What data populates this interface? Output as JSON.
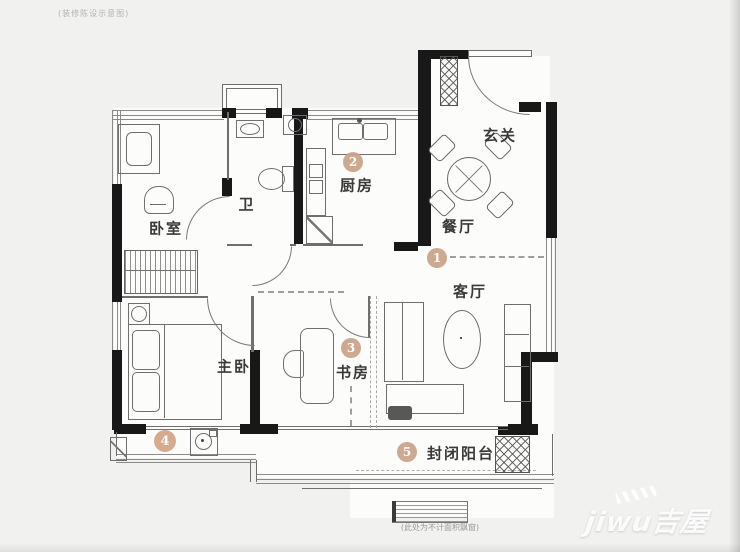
{
  "meta": {
    "top_note": "(装修陈设示意图)",
    "bottom_note": "(此处为不计面积飘窗)"
  },
  "colors": {
    "accent": "#c9a184",
    "wall": "#181818",
    "line": "#6f6f6f",
    "paper": "#fcfcfb",
    "background": "#f1f1ef"
  },
  "rooms": {
    "foyer": "玄关",
    "dining": "餐厅",
    "living": "客厅",
    "kitchen": "厨房",
    "bath": "卫",
    "bedroom": "卧室",
    "master": "主卧",
    "study": "书房",
    "balcony": "封闭阳台"
  },
  "markers": {
    "m1": "1",
    "m2": "2",
    "m3": "3",
    "m4": "4",
    "m5": "5"
  },
  "watermark": {
    "text": "jiwu吉屋"
  }
}
